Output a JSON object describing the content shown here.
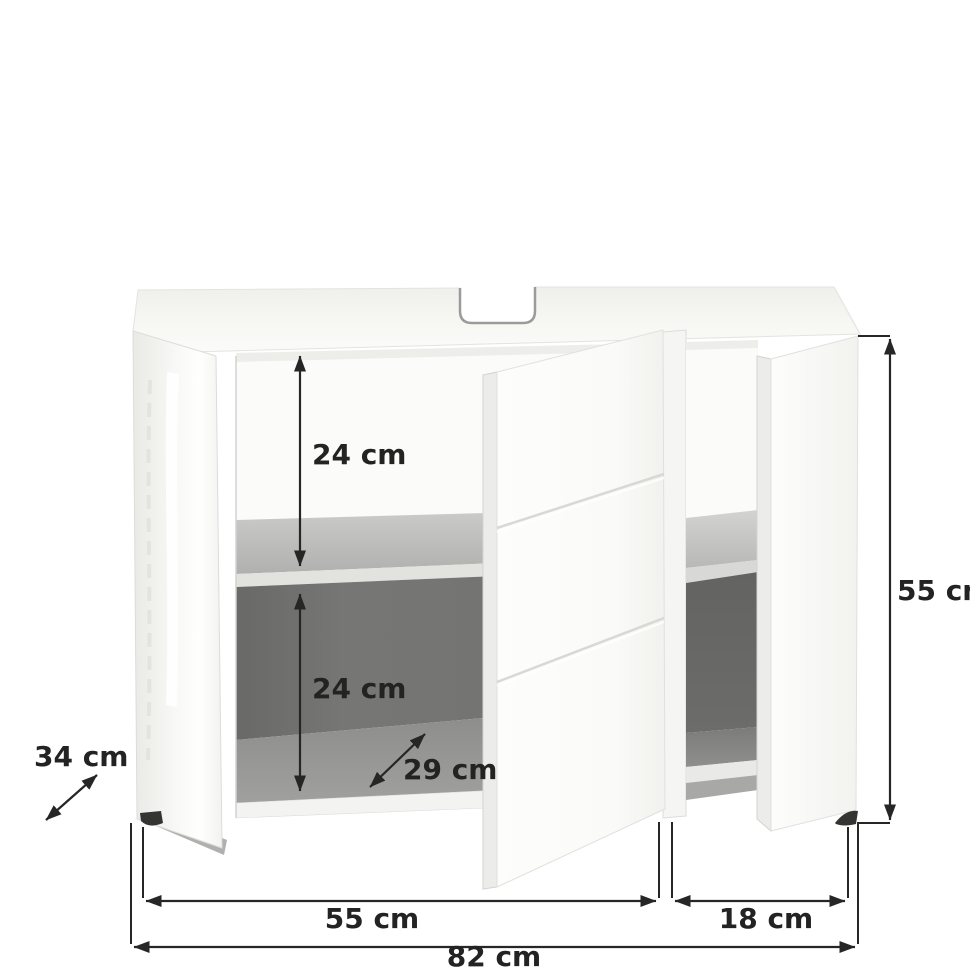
{
  "diagram": {
    "kind": "furniture-dimension-diagram",
    "subject": "under-sink bathroom vanity cabinet with two open doors and middle shelf",
    "unit": "cm",
    "dims": {
      "upper_compartment_height": "24 cm",
      "lower_compartment_height": "24 cm",
      "shelf_depth": "29 cm",
      "cabinet_depth": "34 cm",
      "cabinet_height": "55 cm",
      "left_section_width": "55 cm",
      "right_section_width": "18 cm",
      "total_width": "82 cm"
    },
    "colors": {
      "background": "#ffffff",
      "dimension_line": "#262626",
      "dimension_text": "#232323",
      "cabinet_white": "#f8f8f6",
      "interior_dark": "#6d6d6b",
      "shelf_gray": "#bdbdbb"
    }
  }
}
